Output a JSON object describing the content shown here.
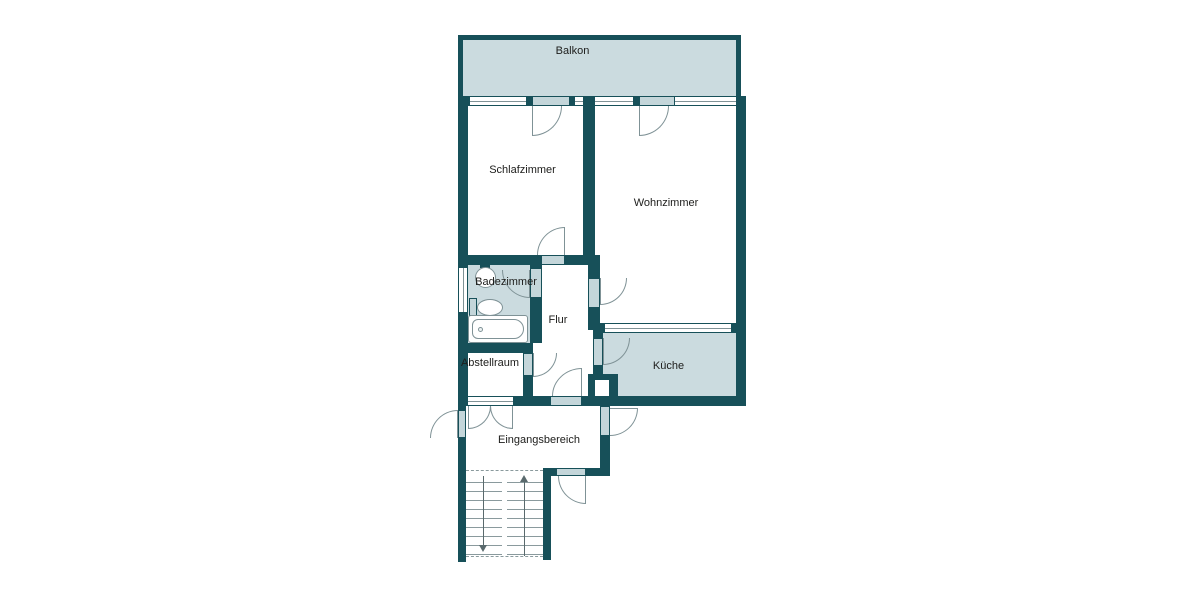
{
  "plan": {
    "type": "apartment-floor-plan",
    "labels": {
      "balkon": "Balkon",
      "schlafzimmer": "Schlafzimmer",
      "wohnzimmer": "Wohnzimmer",
      "badezimmer": "Badezimmer",
      "flur": "Flur",
      "abstellraum": "Abstellraum",
      "kueche": "Küche",
      "eingangsbereich": "Eingangsbereich"
    },
    "icons": {
      "washbasin": "css-circle",
      "toilet": "css-ellipse",
      "bathtub": "css-rounded-rect",
      "door-swing": "css-quarter-arc",
      "stairs-up-arrow": "css-arrow-up",
      "stairs-down-arrow": "css-arrow-down"
    },
    "colors": {
      "wall": "#175059",
      "room": "#cbdbdf",
      "leaf": "#c4d6da",
      "arc": "#7f9296",
      "text": "#1d1d1b",
      "bg": "#ffffff"
    }
  }
}
